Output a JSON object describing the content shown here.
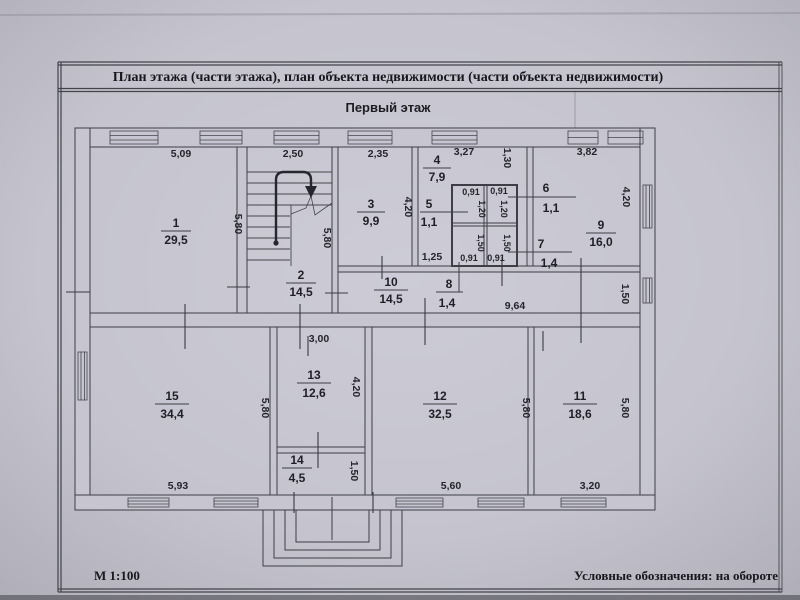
{
  "document": {
    "title": "План этажа (части этажа), план объекта недвижимости (части объекта недвижимости)",
    "subtitle": "Первый этаж",
    "scale_label": "М 1:100",
    "legend_label": "Условные обозначения: на обороте"
  },
  "rooms": [
    {
      "number": "1",
      "area": "29,5"
    },
    {
      "number": "2",
      "area": "14,5"
    },
    {
      "number": "3",
      "area": "9,9"
    },
    {
      "number": "4",
      "area": "7,9"
    },
    {
      "number": "5",
      "area": "1,1"
    },
    {
      "number": "6",
      "area": "1,1"
    },
    {
      "number": "7",
      "area": "1,4"
    },
    {
      "number": "8",
      "area": "1,4"
    },
    {
      "number": "9",
      "area": "16,0"
    },
    {
      "number": "10",
      "area": "14,5"
    },
    {
      "number": "11",
      "area": "18,6"
    },
    {
      "number": "12",
      "area": "32,5"
    },
    {
      "number": "13",
      "area": "12,6"
    },
    {
      "number": "14",
      "area": "4,5"
    },
    {
      "number": "15",
      "area": "34,4"
    }
  ],
  "dims": [
    "5,09",
    "2,50",
    "2,35",
    "3,27",
    "3,82",
    "5,80",
    "5,80",
    "4,20",
    "1,30",
    "4,20",
    "0,91",
    "1,20",
    "0,91",
    "1,20",
    "1,50",
    "1,50",
    "0,91",
    "0,91",
    "1,25",
    "9,64",
    "1,50",
    "3,00",
    "5,80",
    "4,20",
    "5,80",
    "5,80",
    "1,50",
    "5,93",
    "5,60",
    "3,20"
  ]
}
